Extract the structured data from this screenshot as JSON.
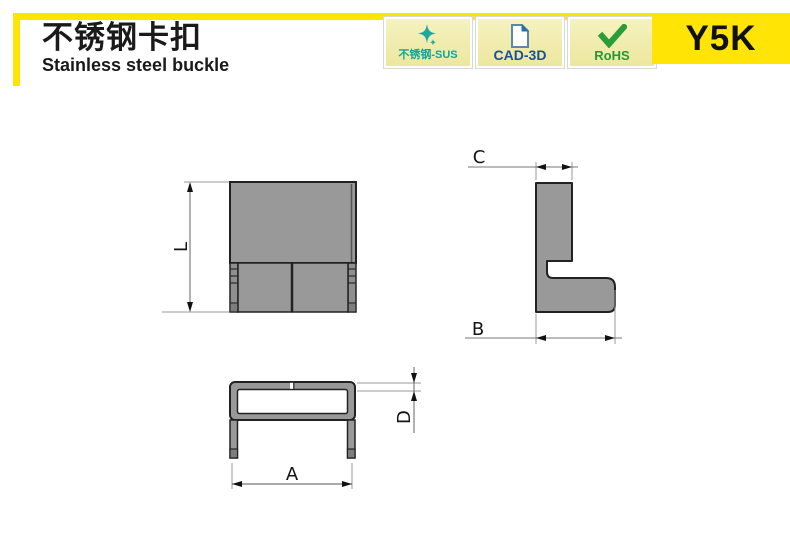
{
  "header": {
    "title_cn": "不锈钢卡扣",
    "title_en": "Stainless steel buckle",
    "part_number": "Y5K",
    "accent_color": "#ffe405",
    "badges": [
      {
        "label": "不锈钢-SUS",
        "icon": "sparkle-star-icon",
        "color": "#12a39c"
      },
      {
        "label": "CAD-3D",
        "icon": "cad-document-icon",
        "color": "#1b4d9e"
      },
      {
        "label": "RoHS",
        "icon": "rohs-check-icon",
        "color": "#219a36"
      }
    ]
  },
  "drawing": {
    "part_fill": "#999999",
    "part_fill_dark": "#7d7d7d",
    "outline": "#222222",
    "dim_labels": {
      "L": "L",
      "C": "C",
      "B": "B",
      "A": "A",
      "D": "D"
    }
  }
}
